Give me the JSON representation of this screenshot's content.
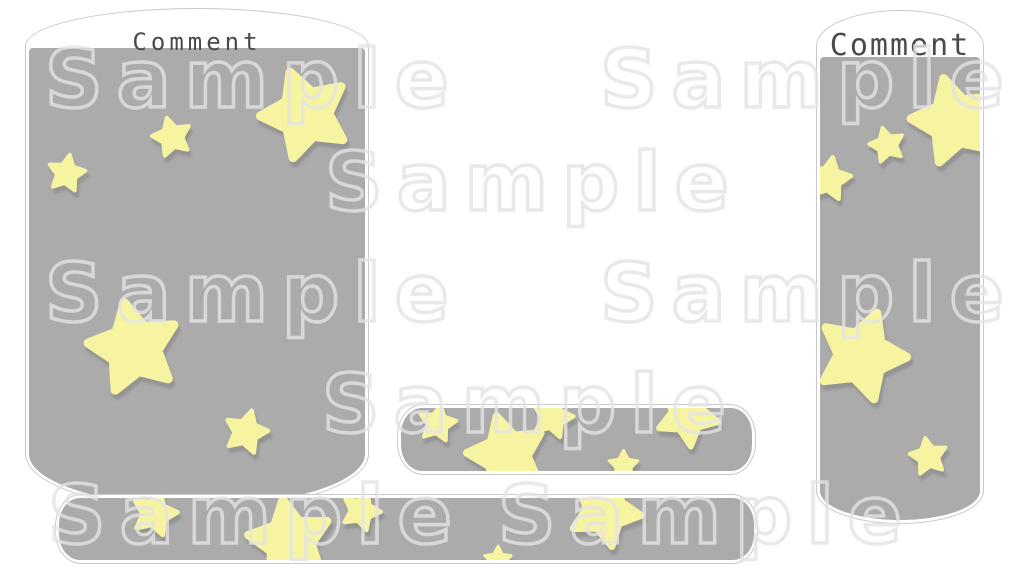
{
  "colors": {
    "panel_gray": "#ababab",
    "outline": "#c9c9c9",
    "star_yellow": "#f7f4a1",
    "star_shadow": "rgba(125,125,125,0.5)",
    "label_text": "#4a4a4a",
    "watermark": "rgba(228,228,228,0.8)"
  },
  "star_path": "M0,-50 L15.3,-21 L47.6,-15.5 L24.7,8 L29.4,40.5 L0,26 L-29.4,40.5 L-24.7,8 L-47.6,-15.5 L-15.3,-21 Z",
  "watermark": {
    "text": "Sample",
    "positions": [
      {
        "x": 45,
        "y": 34
      },
      {
        "x": 600,
        "y": 34
      },
      {
        "x": 325,
        "y": 137
      },
      {
        "x": 45,
        "y": 248
      },
      {
        "x": 600,
        "y": 248
      },
      {
        "x": 322,
        "y": 359
      },
      {
        "x": 48,
        "y": 470
      },
      {
        "x": 498,
        "y": 470
      }
    ]
  },
  "panels": {
    "left": {
      "label": "Comment",
      "stars": [
        {
          "x": 276,
          "y": 66,
          "r": 45,
          "rot": -20
        },
        {
          "x": 143,
          "y": 89,
          "r": 20,
          "rot": -15
        },
        {
          "x": 37,
          "y": 125,
          "r": 19,
          "rot": 10
        },
        {
          "x": 105,
          "y": 300,
          "r": 46,
          "rot": -12
        },
        {
          "x": 217,
          "y": 384,
          "r": 22,
          "rot": 15
        }
      ]
    },
    "right": {
      "label": "Comment",
      "stars": [
        {
          "x": 67,
          "y": 88,
          "r": 18,
          "rot": -15
        },
        {
          "x": 135,
          "y": 64,
          "r": 44,
          "rot": -15
        },
        {
          "x": 9,
          "y": 122,
          "r": 22,
          "rot": 10
        },
        {
          "x": 41,
          "y": 298,
          "r": 45,
          "rot": 20
        },
        {
          "x": 108,
          "y": 399,
          "r": 19,
          "rot": -10
        }
      ]
    },
    "bar_middle": {
      "stars": [
        {
          "x": 36,
          "y": 15,
          "r": 19,
          "rot": 10
        },
        {
          "x": 151,
          "y": 9,
          "r": 21,
          "rot": 15
        },
        {
          "x": 106,
          "y": 47,
          "r": 40,
          "rot": -15
        },
        {
          "x": 286,
          "y": 7,
          "r": 31,
          "rot": 30
        },
        {
          "x": 222,
          "y": 57,
          "r": 15,
          "rot": 0
        }
      ]
    },
    "bar_bottom": {
      "stars": [
        {
          "x": 95,
          "y": 15,
          "r": 23,
          "rot": 15
        },
        {
          "x": 231,
          "y": 43,
          "r": 42,
          "rot": -10
        },
        {
          "x": 302,
          "y": 13,
          "r": 20,
          "rot": 20
        },
        {
          "x": 546,
          "y": 13,
          "r": 36,
          "rot": 25
        },
        {
          "x": 439,
          "y": 62,
          "r": 14,
          "rot": 0
        }
      ]
    }
  }
}
